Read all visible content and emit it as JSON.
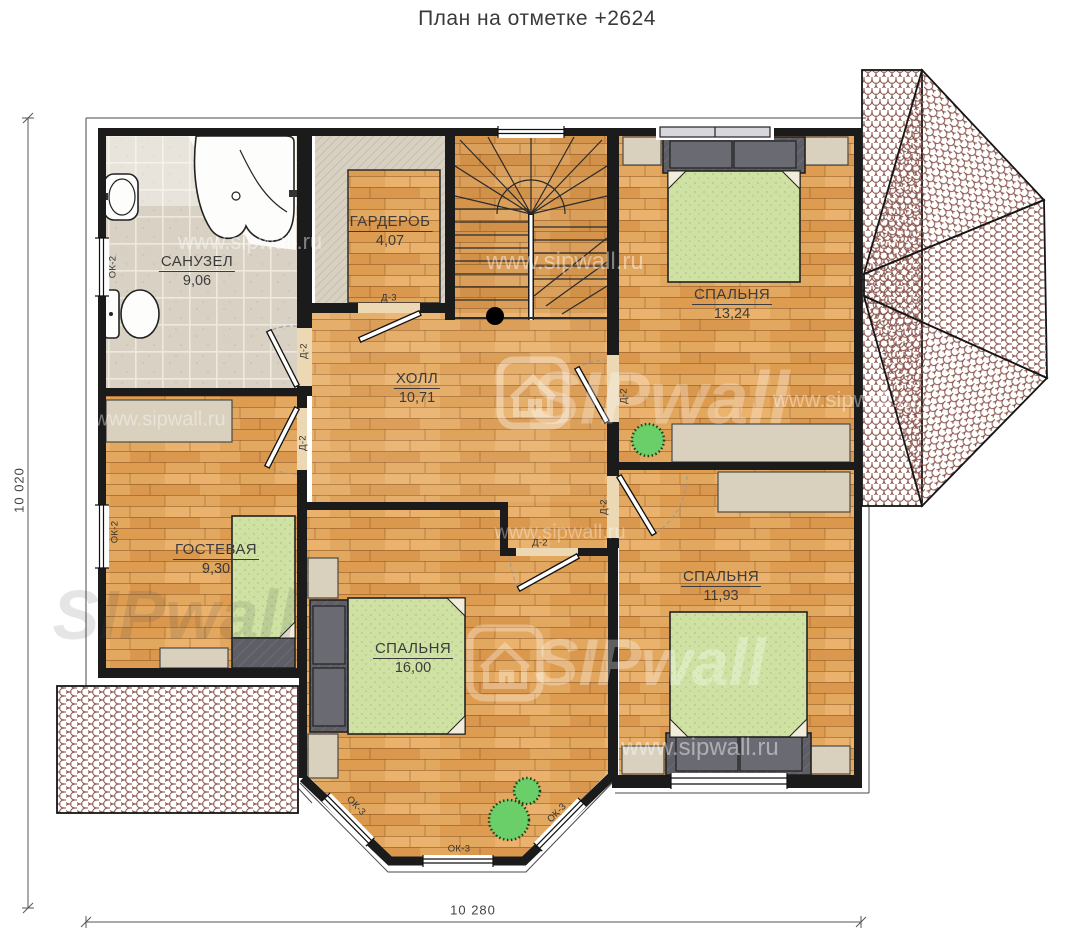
{
  "title": "План на отметке +2624",
  "dimensions": {
    "vertical": "10 020",
    "horizontal": "10 280"
  },
  "rooms": {
    "bathroom": {
      "name": "САНУЗЕЛ",
      "area": "9,06"
    },
    "wardrobe": {
      "name": "ГАРДЕРОБ",
      "area": "4,07"
    },
    "hall": {
      "name": "ХОЛЛ",
      "area": "10,71"
    },
    "bedroom_top": {
      "name": "СПАЛЬНЯ",
      "area": "13,24"
    },
    "guest": {
      "name": "ГОСТЕВАЯ",
      "area": "9,30"
    },
    "bedroom_center": {
      "name": "СПАЛЬНЯ",
      "area": "16,00"
    },
    "bedroom_right": {
      "name": "СПАЛЬНЯ",
      "area": "11,93"
    }
  },
  "labels": {
    "door_d2": "Д-2",
    "door_d3": "Д-3",
    "window_ok2": "ОК-2",
    "window_ok3": "ОК-3"
  },
  "watermark": {
    "brand": "SIPwall",
    "url": "www.sipwall.ru"
  },
  "colors": {
    "wood_floor": "#e3a860",
    "tile_floor": "#d9d2c4",
    "mattress_green": "#cfe2a3",
    "furniture_dark": "#5e5e66",
    "furniture_light": "#d9d0be",
    "roof_tile": "#8b564d",
    "plant_green": "#6bcf69",
    "wall_black": "#1b1b1b"
  }
}
